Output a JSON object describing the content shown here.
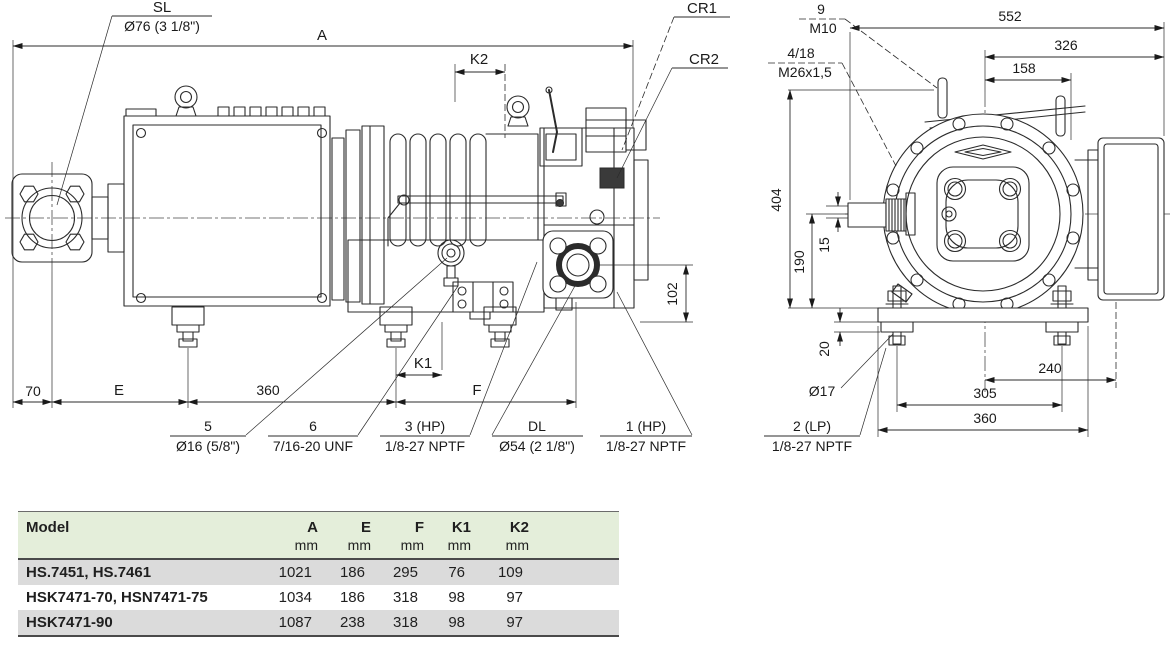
{
  "colors": {
    "ink": "#2b2b2b",
    "table_header_bg": "#e4eeda",
    "table_row_alt_bg": "#dbdbdb"
  },
  "drawing": {
    "side_view": {
      "sl": {
        "code": "SL",
        "size": "Ø76 (3 1/8\")"
      },
      "dim_a": "A",
      "dim_k2": "K2",
      "cr1": "CR1",
      "cr2": "CR2",
      "dim_102": "102",
      "dim_70": "70",
      "dim_e": "E",
      "dim_360": "360",
      "dim_k1": "K1",
      "dim_f": "F",
      "ports": [
        {
          "code": "5",
          "size": "Ø16 (5/8\")"
        },
        {
          "code": "6",
          "size": "7/16-20 UNF"
        },
        {
          "code": "3 (HP)",
          "size": "1/8-27 NPTF"
        },
        {
          "code": "DL",
          "size": "Ø54 (2 1/8\")"
        },
        {
          "code": "1 (HP)",
          "size": "1/8-27 NPTF"
        }
      ]
    },
    "end_view": {
      "m10": {
        "code": "9",
        "size": "M10"
      },
      "m26": {
        "code": "4/18",
        "size": "M26x1,5"
      },
      "dim_552": "552",
      "dim_326": "326",
      "dim_158": "158",
      "dim_404": "404",
      "dim_190": "190",
      "dim_15": "15",
      "dim_20": "20",
      "dim_o17": "Ø17",
      "dim_240": "240",
      "dim_305": "305",
      "dim_360": "360",
      "port_lp": {
        "code": "2 (LP)",
        "size": "1/8-27 NPTF"
      }
    }
  },
  "table": {
    "col_headers": [
      "Model",
      "A",
      "E",
      "F",
      "K1",
      "K2"
    ],
    "unit_row": [
      "",
      "mm",
      "mm",
      "mm",
      "mm",
      "mm"
    ],
    "rows": [
      {
        "model": "HS.7451, HS.7461",
        "values": [
          "1021",
          "186",
          "295",
          "76",
          "109"
        ]
      },
      {
        "model": "HSK7471-70, HSN7471-75",
        "values": [
          "1034",
          "186",
          "318",
          "98",
          "97"
        ]
      },
      {
        "model": "HSK7471-90",
        "values": [
          "1087",
          "238",
          "318",
          "98",
          "97"
        ]
      }
    ]
  }
}
